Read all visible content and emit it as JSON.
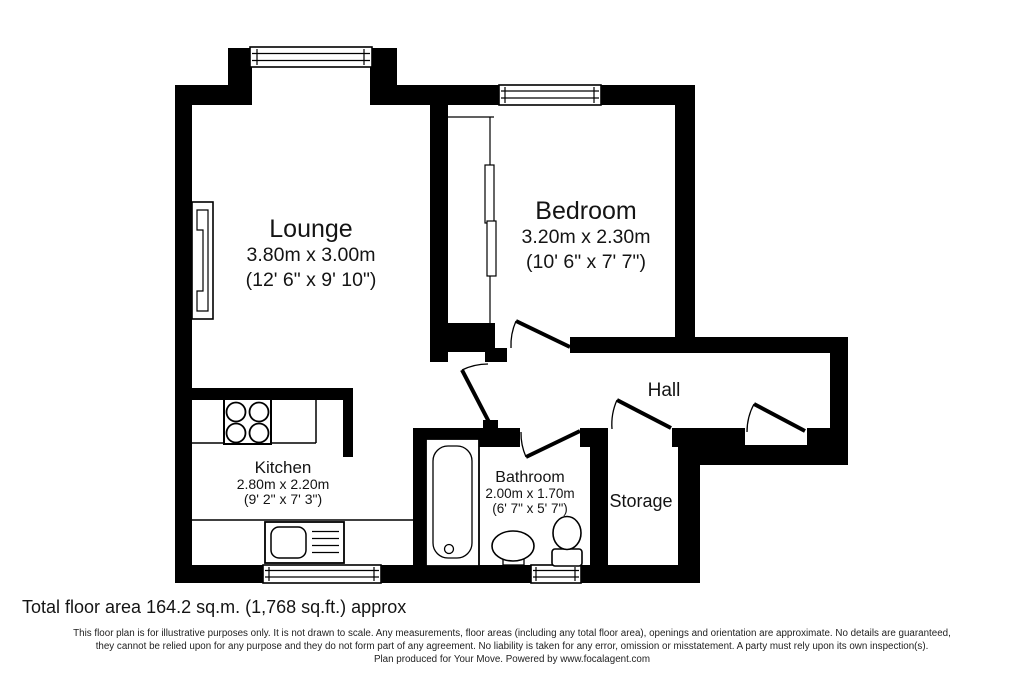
{
  "palette": {
    "background": "#ffffff",
    "wall_color": "#000000",
    "text_color": "#141414"
  },
  "rooms": {
    "lounge": {
      "name": "Lounge",
      "metric": "3.80m x 3.00m",
      "imperial": "(12' 6\" x 9' 10\")"
    },
    "bedroom": {
      "name": "Bedroom",
      "metric": "3.20m x 2.30m",
      "imperial": "(10' 6\" x 7' 7\")"
    },
    "kitchen": {
      "name": "Kitchen",
      "metric": "2.80m x 2.20m",
      "imperial": "(9' 2\" x 7' 3\")"
    },
    "bathroom": {
      "name": "Bathroom",
      "metric": "2.00m x 1.70m",
      "imperial": "(6' 7\" x 5' 7\")"
    },
    "hall": {
      "name": "Hall"
    },
    "storage": {
      "name": "Storage"
    }
  },
  "summary": {
    "total_area": "Total floor area 164.2 sq.m. (1,768 sq.ft.) approx"
  },
  "disclaimer": {
    "line1": "This floor plan is for illustrative purposes only. It is not drawn to scale. Any measurements, floor areas (including any total floor area), openings and orientation are approximate. No details are guaranteed,",
    "line2": "they cannot be relied upon for any purpose and they do not form part of any agreement. No liability is taken for any error, omission or misstatement. A party must rely upon its own inspection(s).",
    "line3": "Plan produced for Your Move. Powered by www.focalagent.com"
  }
}
